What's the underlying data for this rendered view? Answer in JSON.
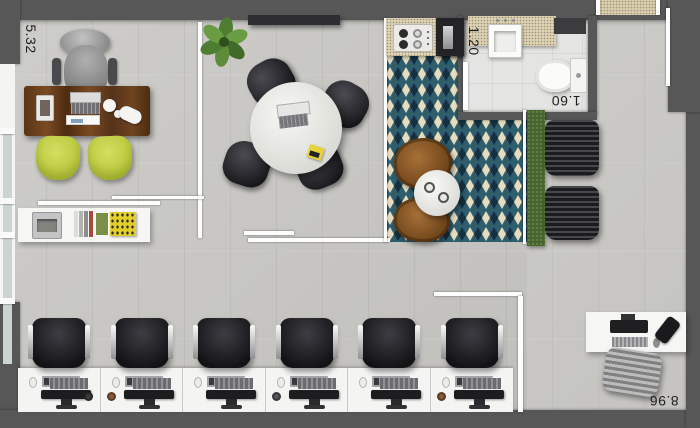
{
  "plan": {
    "dimension_labels": {
      "left_height": "5.32",
      "bathroom_width": "1.20",
      "bathroom_height": "1.60",
      "bottom_width": "8.96"
    },
    "colors": {
      "wall": "#575757",
      "floor": "#cac9c5",
      "tile_teal": "#2e5d6e",
      "tile_navy": "#16303f",
      "tile_cream": "#e9dcbc",
      "chair_yellow": "#c6d34c",
      "desk_wood": "#5e3a1c",
      "hedge_green": "#46632f",
      "counter_beige": "#ddd3b4"
    },
    "rooms": {
      "executive_office": {
        "furniture": [
          "executive-desk",
          "executive-chair",
          "laptop",
          "paper-tray",
          "desk-phone",
          "guest-chair",
          "guest-chair",
          "credenza",
          "printer",
          "books",
          "magazine"
        ]
      },
      "meeting_room": {
        "furniture": [
          "round-table",
          "meeting-chair",
          "meeting-chair",
          "meeting-chair",
          "meeting-chair",
          "laptop",
          "notes",
          "sideboard",
          "plant"
        ]
      },
      "kitchen": {
        "furniture": [
          "counter",
          "cooktop",
          "coffee-station"
        ]
      },
      "bathroom": {
        "furniture": [
          "sink-counter",
          "sink",
          "wall-niche",
          "toilet",
          "door"
        ]
      },
      "lounge": {
        "furniture": [
          "patterned-tile-floor",
          "wood-chair",
          "wood-chair",
          "coffee-table",
          "cups",
          "hedge",
          "slat-lounge",
          "slat-lounge"
        ]
      },
      "open_office": {
        "workstation_count": 6,
        "furniture_per_station": [
          "office-chair",
          "keyboard",
          "monitor",
          "mouse"
        ]
      },
      "reception": {
        "furniture": [
          "reception-desk",
          "monitor",
          "keyboard",
          "mouse",
          "phone",
          "office-chair"
        ]
      },
      "entrance": {
        "furniture": [
          "doormat",
          "door-frame"
        ]
      }
    }
  }
}
